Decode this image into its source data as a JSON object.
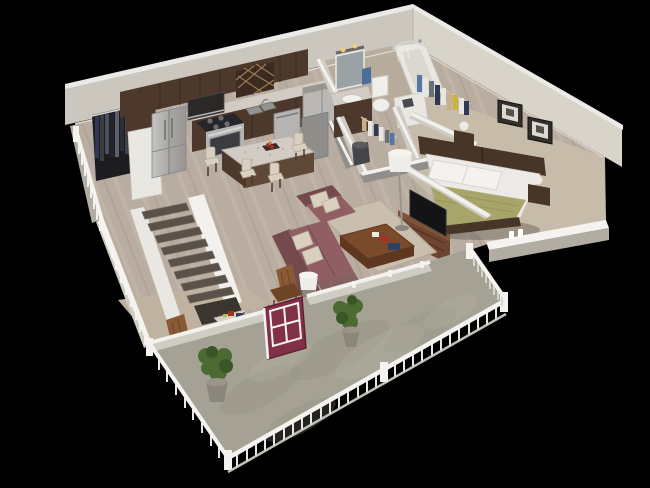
{
  "scene": {
    "type": "3d-isometric-floor-plan-render",
    "unit": "one-bedroom-apartment-with-balcony",
    "rooms": [
      {
        "name": "kitchen",
        "objects": [
          "upper-cabinets",
          "wine-rack",
          "refrigerator",
          "microwave",
          "stove",
          "sink",
          "dishwasher",
          "granite-island",
          "bar-stools",
          "coat-closet"
        ]
      },
      {
        "name": "bathroom",
        "objects": [
          "vanity",
          "mirror",
          "vanity-lights",
          "toilet",
          "towel",
          "bathtub-shower",
          "laundry-cabinet"
        ]
      },
      {
        "name": "walk-in-closets",
        "objects": [
          "hanging-clothes",
          "laundry-hamper"
        ]
      },
      {
        "name": "bedroom",
        "objects": [
          "bed",
          "green-blanket",
          "headboard",
          "nightstands",
          "table-lamps",
          "framed-pictures",
          "window-sill"
        ]
      },
      {
        "name": "living-room",
        "objects": [
          "loveseat",
          "armchair",
          "ottoman",
          "throw-pillows",
          "area-rug",
          "coffee-table",
          "tv-console",
          "flat-tv",
          "floor-lamp",
          "drum-lamp",
          "rocking-chair"
        ]
      },
      {
        "name": "office-nook",
        "objects": [
          "desk",
          "wooden-chair",
          "maroon-french-door"
        ]
      },
      {
        "name": "stairs",
        "objects": [
          "staircase",
          "white-stringer-walls"
        ]
      },
      {
        "name": "balcony",
        "objects": [
          "concrete-deck",
          "white-picket-railing",
          "potted-plants"
        ]
      }
    ]
  },
  "palette": {
    "bg": "#000000",
    "wallLeft": "#cbc7bf",
    "wallRight": "#d9d4ca",
    "wallTrim": "#eceae6",
    "wallShadow": "#b2ada3",
    "wallBandLight": "#cfccc4",
    "partitionGray": "#8f8e8a",
    "capWhite": "#f2f1ee",
    "floorWood": "#b9aca0",
    "floorWoodStreakLight": "#cdc2b4",
    "floorWoodStreakDark": "#9b8f82",
    "tileBath": "#b6aa9b",
    "carpetBedroom": "#c7bcaa",
    "carpetOffice": "#bfb2a0",
    "rug": "#cabfae",
    "rugEdge": "#b7ac9a",
    "deck": "#a5a295",
    "deckMottleDark": "#8e8c7a",
    "deckMottleLight": "#b7b4a4",
    "railWhite": "#f4f3f0",
    "railShade": "#d5d3cd",
    "cabinetDark": "#4d392c",
    "cabinetMid": "#5f4836",
    "granite": "#d2ccc5",
    "graniteDark": "#b9b3ac",
    "steel": "#b5b4b2",
    "steelDark": "#8f8e8c",
    "applianceGray": "#b9b8b4",
    "tvBlack": "#141416",
    "sofa": "#915f63",
    "sofaDark": "#744a4e",
    "pillowCream": "#d9d0bf",
    "woodTable": "#7b4a2a",
    "woodTableDark": "#5e3720",
    "tvConsole": "#6e4530",
    "tvConsoleTop": "#7d5238",
    "bedWhite": "#eceae6",
    "blanketGreen": "#a7a569",
    "blanketGreenDark": "#8f8e55",
    "headboard": "#473528",
    "doorMaroon": "#822f4a",
    "doorMaroonDark": "#5e2235",
    "plantGreen": "#4c6b33",
    "plantGreenDark": "#3a5526",
    "potGray": "#8b867c",
    "chairWood": "#8a5a34",
    "chairWoodDark": "#6e4426",
    "clothesNavy": "#2e3a55",
    "clothesBlue": "#5577a8",
    "clothesGray": "#6a6f78",
    "clothesTan": "#c9b089",
    "clothesWhite": "#e8e6e0",
    "clothesYellow": "#c9b43f",
    "stairTread": "#5a5248",
    "stairEdge": "#6e675d",
    "stairWell": "#3a352f",
    "stringerWhite": "#e9e7e2",
    "mirror": "#9aa2a6",
    "lampShade": "#efede8",
    "fixtureWhite": "#e9e7e2",
    "fixtureShade": "#cfccc6",
    "hamper": "#44464a",
    "towelBlue": "#4a6d99",
    "accentRed": "#a33226",
    "accentOrange": "#c97b2a",
    "lightYellow": "#e8cf7e",
    "shadow": "#000000"
  }
}
